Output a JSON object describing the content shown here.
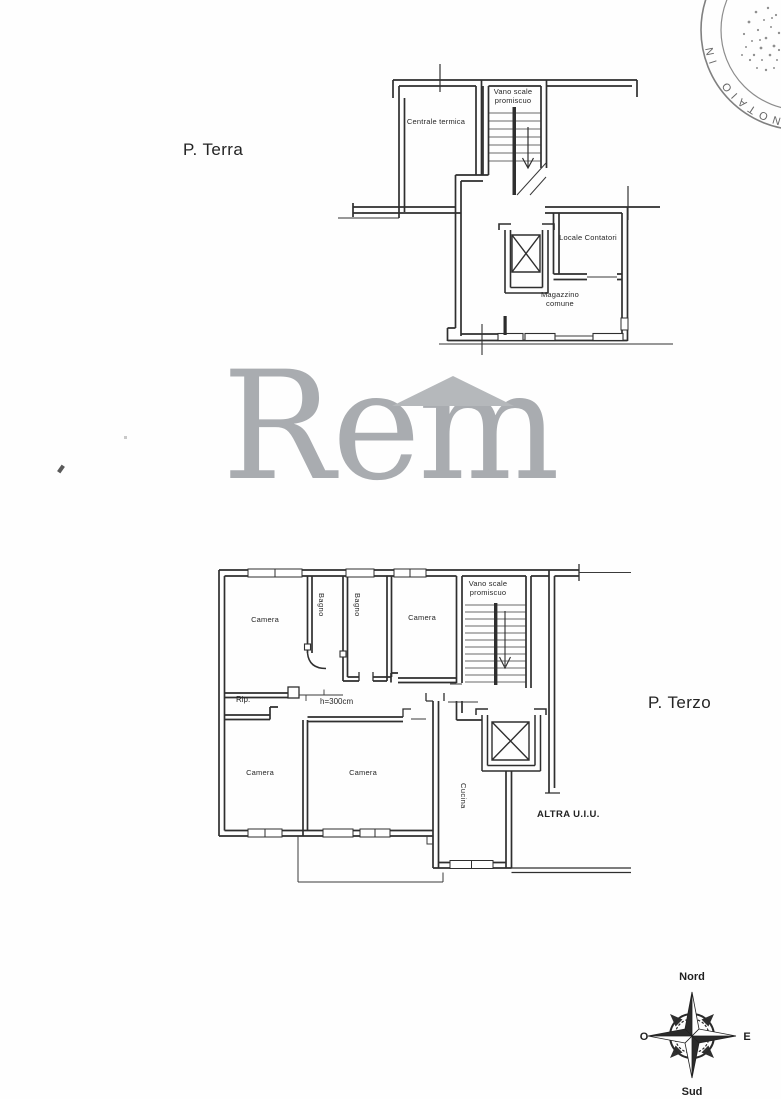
{
  "stamp": {
    "arc_text": "NOTAIO IN"
  },
  "plan_terra": {
    "title": "P. Terra",
    "labels": {
      "centrale_termica": "Centrale termica",
      "vano_scale": "Vano scale promiscuo",
      "locale_contatori": "Locale Contatori",
      "magazzino_comune": "Magazzino comune"
    }
  },
  "watermark": {
    "text": "Rem"
  },
  "plan_terzo": {
    "title": "P. Terzo",
    "labels": {
      "camera_nw": "Camera",
      "bagno_1": "Bagno",
      "bagno_2": "Bagno",
      "camera_ne": "Camera",
      "vano_scale": "Vano scale promiscuo",
      "rip": "Rip.",
      "height_note": "h=300cm",
      "camera_sw": "Camera",
      "camera_s": "Camera",
      "cucina": "Cucina",
      "altra_uiu": "ALTRA U.I.U."
    }
  },
  "compass": {
    "north": "Nord",
    "south": "Sud",
    "west": "O",
    "east": "E"
  },
  "colors": {
    "ink": "#2f2f2f",
    "watermark": "#a9acb0",
    "stamp": "#5a5a5a"
  }
}
